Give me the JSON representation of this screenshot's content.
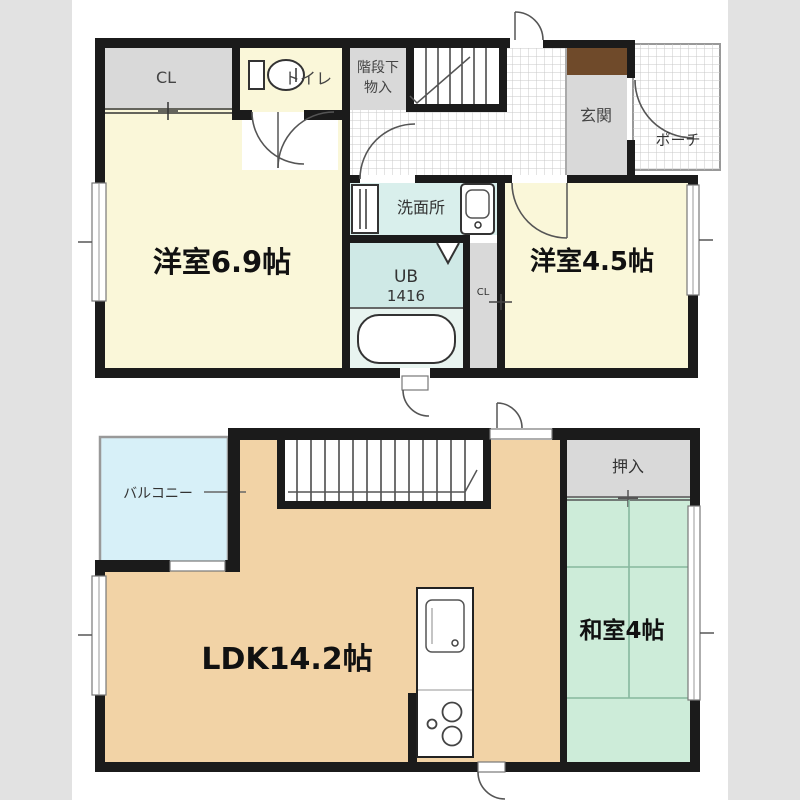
{
  "upper_floor": {
    "closet": "CL",
    "toilet": "トイレ",
    "under_stairs_storage_line1": "階段下",
    "under_stairs_storage_line2": "物入",
    "entrance": "玄関",
    "porch": "ポーチ",
    "washroom": "洗面所",
    "unit_bath_line1": "UB",
    "unit_bath_line2": "1416",
    "closet_small": "CL",
    "western_room_69": "洋室6.9帖",
    "western_room_45": "洋室4.5帖"
  },
  "lower_floor": {
    "balcony": "バルコニー",
    "oshiire": "押入",
    "ldk": "LDK14.2帖",
    "japanese_room": "和室4帖"
  },
  "colors": {
    "wall": "#1b1b1b",
    "room_cream": "#faf7d9",
    "room_gray": "#d9d9d9",
    "room_peach": "#f2d3a6",
    "room_green": "#cdecd9",
    "washroom_cyan": "#d9efec",
    "bath_cyan": "#cfe9e6",
    "balcony_blue": "#d7f0f8",
    "entrance_step_brown": "#6f4a2a",
    "background_band": "#e2e2e2"
  }
}
